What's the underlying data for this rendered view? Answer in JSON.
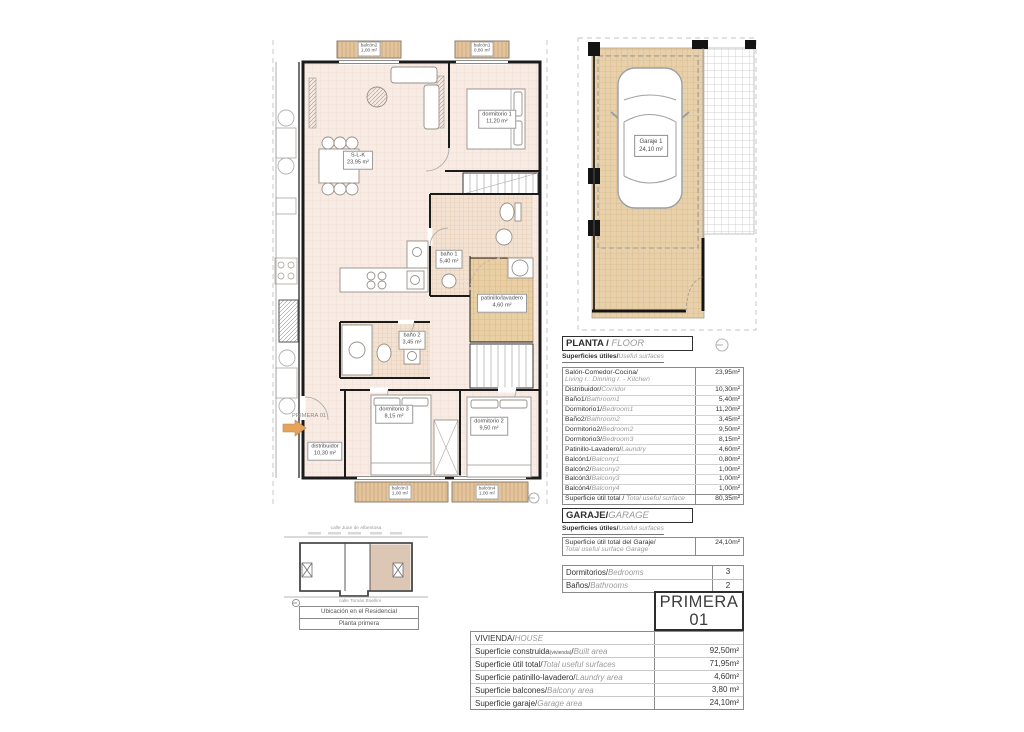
{
  "page": {
    "footer": "DIN A4 - e:1/75"
  },
  "colors": {
    "floor_fill": "#f8ebe3",
    "balcony_fill": "#e4c49c",
    "garage_fill": "#e8d1aa",
    "bath_tile": "#f3e2d1",
    "patinillo_fill": "#e9cfa4",
    "highlight_unit": "#dcc7b4",
    "entry_arrow": "#e6a35c"
  },
  "floor_plan": {
    "entry_label": "PRIMERA 01",
    "rooms": [
      {
        "name": "S-L-K",
        "area": "23,95 m²"
      },
      {
        "name": "dormitorio 1",
        "area": "11,20 m²"
      },
      {
        "name": "baño 1",
        "area": "5,40 m²"
      },
      {
        "name": "patinillo/lavadero",
        "area": "4,60 m²"
      },
      {
        "name": "baño 2",
        "area": "3,45 m²"
      },
      {
        "name": "dormitorio 3",
        "area": "8,15 m²"
      },
      {
        "name": "dormitorio 2",
        "area": "9,50 m²"
      },
      {
        "name": "distribuidor",
        "area": "10,30 m²"
      }
    ],
    "balconies": [
      {
        "name": "balcón2",
        "area": "1,00 m²"
      },
      {
        "name": "balcón1",
        "area": "0,80 m²"
      },
      {
        "name": "balcón3",
        "area": "1,00 m²"
      },
      {
        "name": "balcón4",
        "area": "1,00 m²"
      }
    ]
  },
  "garage_plan": {
    "name": "Garaje 1",
    "area": "24,10 m²"
  },
  "location": {
    "street_top": "calle Juan de Albentosa",
    "street_bottom": "calle Tomás Boellini",
    "caption_line1": "Ubicación en el Residencial",
    "caption_line2": "Planta primera"
  },
  "planta_table": {
    "title_es": "PLANTA / ",
    "title_en": "FLOOR",
    "subtitle_es": "Superficies útiles/",
    "subtitle_en": "Useful surfaces",
    "rows": [
      {
        "es": "Salón-Comedor-Cocina/",
        "en": "Living r.: Dinning r. - Kitchen",
        "value": "23,95m²"
      },
      {
        "es": "Distribuidor/",
        "en": "Corridor",
        "value": "10,30m²"
      },
      {
        "es": "Baño1/",
        "en": "Bathroom1",
        "value": "5,40m²"
      },
      {
        "es": "Dormitorio1/",
        "en": "Bedroom1",
        "value": "11,20m²"
      },
      {
        "es": "Baño2/",
        "en": "Bathroom2",
        "value": "3,45m²"
      },
      {
        "es": "Dormitorio2/",
        "en": "Bedroom2",
        "value": "9,50m²"
      },
      {
        "es": "Dormitorio3/",
        "en": "Bedroom3",
        "value": "8,15m²"
      },
      {
        "es": "Patinillo-Lavadero/",
        "en": "Laundry",
        "value": "4,60m²"
      },
      {
        "es": "Balcón1/",
        "en": "Balcony1",
        "value": "0,80m²"
      },
      {
        "es": "Balcón2/",
        "en": "Balcony2",
        "value": "1,00m²"
      },
      {
        "es": "Balcón3/",
        "en": "Balcony3",
        "value": "1,00m²"
      },
      {
        "es": "Balcón4/",
        "en": "Balcony4",
        "value": "1,00m²"
      }
    ],
    "total": {
      "es": "Superficie útil total / ",
      "en": "Total useful surface",
      "value": "80,35m²"
    }
  },
  "garaje_table": {
    "title_es": "GARAJE/",
    "title_en": "GARAGE",
    "subtitle_es": "Superficies útiles/",
    "subtitle_en": "Useful surfaces",
    "row_es": "Superficie útil total del Garaje/",
    "row_en": "Total useful surface Garage",
    "row_value": "24,10m²"
  },
  "counts_table": {
    "rows": [
      {
        "es": "Dormitorios/",
        "en": "Bedrooms",
        "value": "3"
      },
      {
        "es": "Baños/",
        "en": "Bathrooms",
        "value": "2"
      }
    ]
  },
  "unit_badge": {
    "line1": "PRIMERA",
    "line2": "01"
  },
  "vivienda_table": {
    "title_es": "VIVIENDA/",
    "title_en": "HOUSE",
    "rows": [
      {
        "es": "Superficie construida",
        "sub": "(vivienda)",
        "slash": "/",
        "en": "Built area",
        "value": "92,50m²"
      },
      {
        "es": "Superficie útil total/",
        "sub": "",
        "slash": "",
        "en": "Total useful surfaces",
        "value": "71,95m²"
      },
      {
        "es": "Superficie patinillo-lavadero/",
        "sub": "",
        "slash": "",
        "en": "Laundry area",
        "value": "4,60m²"
      },
      {
        "es": "Superficie balcones/",
        "sub": "",
        "slash": "",
        "en": "Balcony area",
        "value": "3,80 m²"
      },
      {
        "es": "Superficie garaje/",
        "sub": "",
        "slash": "",
        "en": "Garage area",
        "value": "24,10m²"
      }
    ]
  }
}
